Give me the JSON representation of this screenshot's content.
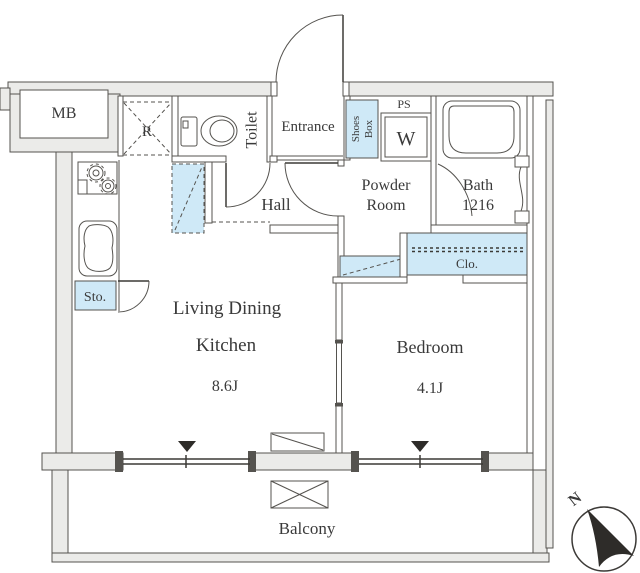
{
  "floor_plan": {
    "rooms": {
      "mb": "MB",
      "refrigerator_space": "R",
      "toilet": "Toilet",
      "entrance": "Entrance",
      "shoes_box_line1": "Shoes",
      "shoes_box_line2": "Box",
      "pipe_space": "PS",
      "washer": "W",
      "powder_room_line1": "Powder",
      "powder_room_line2": "Room",
      "bath_line1": "Bath",
      "bath_line2": "1216",
      "hall": "Hall",
      "closet": "Clo.",
      "storage": "Sto.",
      "ldk_line1": "Living Dining",
      "ldk_line2": "Kitchen",
      "ldk_size": "8.6J",
      "bedroom": "Bedroom",
      "bedroom_size": "4.1J",
      "balcony": "Balcony"
    },
    "compass": {
      "north": "N"
    },
    "colors": {
      "wall_fill": "#ebebe9",
      "highlight_fill": "#cfe9f7",
      "line": "#55534f",
      "text": "#3a3a3a"
    }
  }
}
